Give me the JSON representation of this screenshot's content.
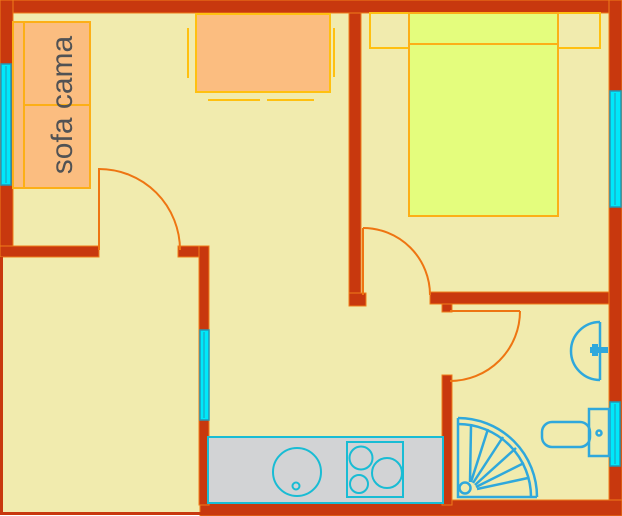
{
  "floorplan": {
    "labels": {
      "sofa_bed": "sofa cama"
    },
    "palette": {
      "wall": "#c8380e",
      "wall_outline": "#ef7d1a",
      "floor": "#f1ebae",
      "furniture_fill": "#fbbd80",
      "furniture_border": "#fcaf17",
      "accent_border": "#ffc010",
      "bed_fill": "#e4fd7d",
      "window_fill": "#00e8fa",
      "window_border": "#2496b4",
      "door": "#ee7512",
      "kitchen_line": "#19bcd4",
      "counter_fill": "#d2d3d5",
      "bath_line": "#2fa8dc",
      "label_text": "#515254",
      "background": "#ffffff"
    }
  }
}
